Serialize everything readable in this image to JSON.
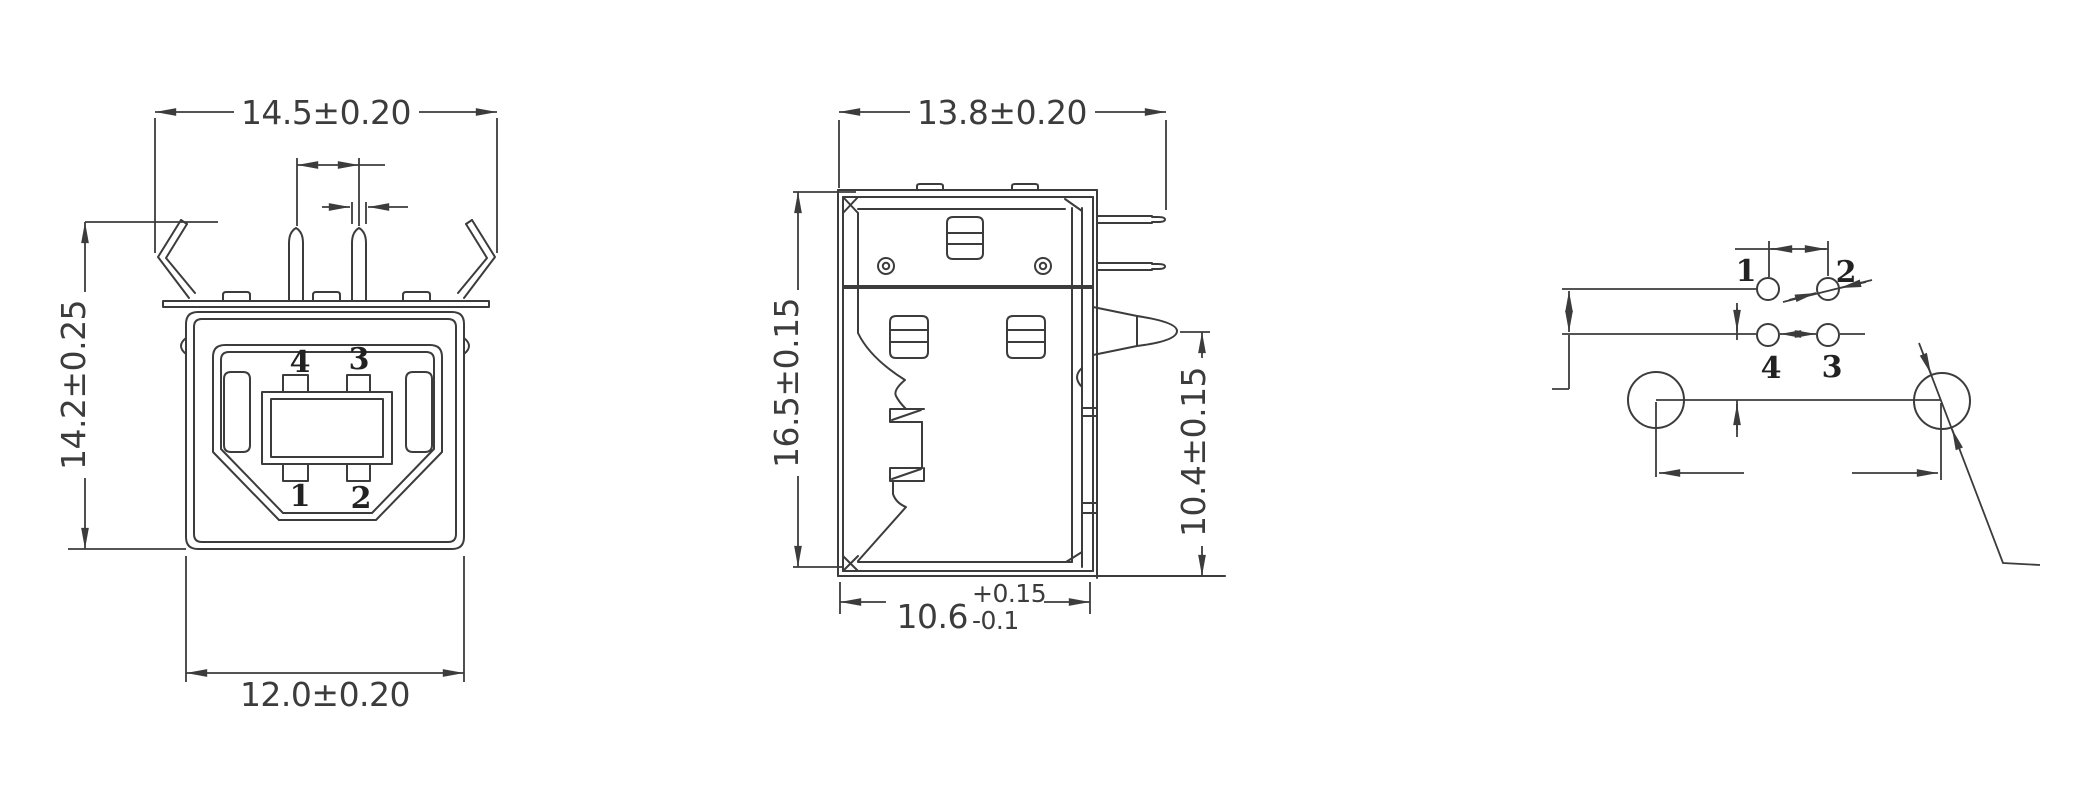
{
  "front": {
    "dim_top": "14.5±0.20",
    "dim_left": "14.2±0.25",
    "dim_bottom": "12.0±0.20",
    "pin_tl": "4",
    "pin_tr": "3",
    "pin_bl": "1",
    "pin_br": "2"
  },
  "side": {
    "dim_top": "13.8±0.20",
    "dim_left": "16.5±0.15",
    "dim_right": "10.4±0.15",
    "dim_bottom": "10.6",
    "dim_bottom_plus": "+0.15",
    "dim_bottom_minus": "-0.1"
  },
  "footprint": {
    "pin1": "1",
    "pin2": "2",
    "pin3": "3",
    "pin4": "4"
  },
  "colors": {
    "line": "#3c3c3c",
    "background": "#ffffff"
  }
}
